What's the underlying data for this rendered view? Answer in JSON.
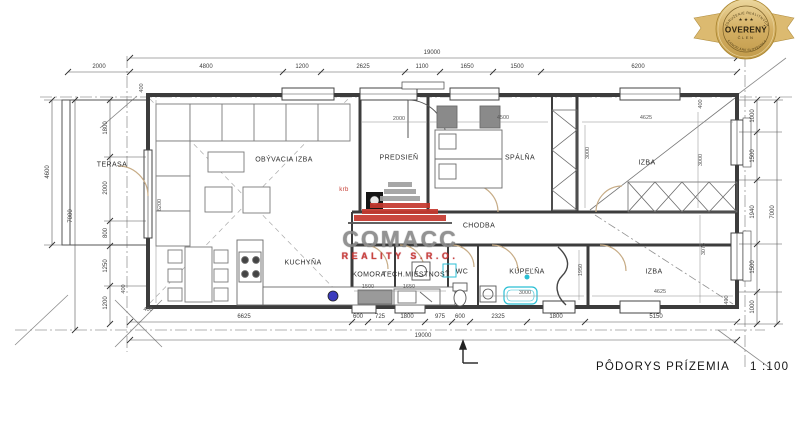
{
  "badge": {
    "arc_top": "ZDRUŽENIE REALITNÝCH",
    "arc_bottom": "KANCELÁRIÍ SLOVENSKA",
    "stars": "★ ★ ★",
    "title": "OVERENÝ",
    "subtitle": "ČLEN"
  },
  "logo": {
    "name": "COMACC",
    "subtitle": "REALITY S.R.O."
  },
  "title_block": {
    "title": "PÔDORYS PRÍZEMIA",
    "scale": "1 :100"
  },
  "rooms": [
    "TERASA",
    "OBÝVACIA IZBA",
    "PREDSIEŇ",
    "SPÁLŇA",
    "IZBA",
    "CHODBA",
    "KUCHYŇA",
    "KOMORA",
    "TECH.MIESTNOSŤ",
    "WC",
    "KÚPEĽŇA",
    "IZBA",
    "krb"
  ],
  "dims": {
    "top_total": "19000",
    "top": [
      "2000",
      "4800",
      "1200",
      "2625",
      "1100",
      "1650",
      "1500",
      "6200"
    ],
    "bottom": [
      "6625",
      "600",
      "725",
      "1800",
      "975",
      "600",
      "2325",
      "1800",
      "5150"
    ],
    "bottom_total": "19000",
    "left": [
      "4600",
      "7000",
      "1800",
      "2000",
      "800",
      "1250",
      "1200"
    ],
    "right": [
      "1000",
      "1500",
      "1940",
      "1500",
      "1000",
      "7000"
    ],
    "inner": [
      "400",
      "6200",
      "2000",
      "4500",
      "3000",
      "400",
      "4625",
      "3000",
      "1500",
      "1650",
      "3000",
      "1950",
      "4625",
      "3075",
      "400",
      "400",
      "400"
    ]
  },
  "palette": {
    "accent_red": "#c5382e",
    "badge_gold": "#d4af63",
    "fixture_cyan": "#2bbfd4",
    "door_tan": "#c7ac86",
    "line_dark": "#3c3c3c"
  }
}
